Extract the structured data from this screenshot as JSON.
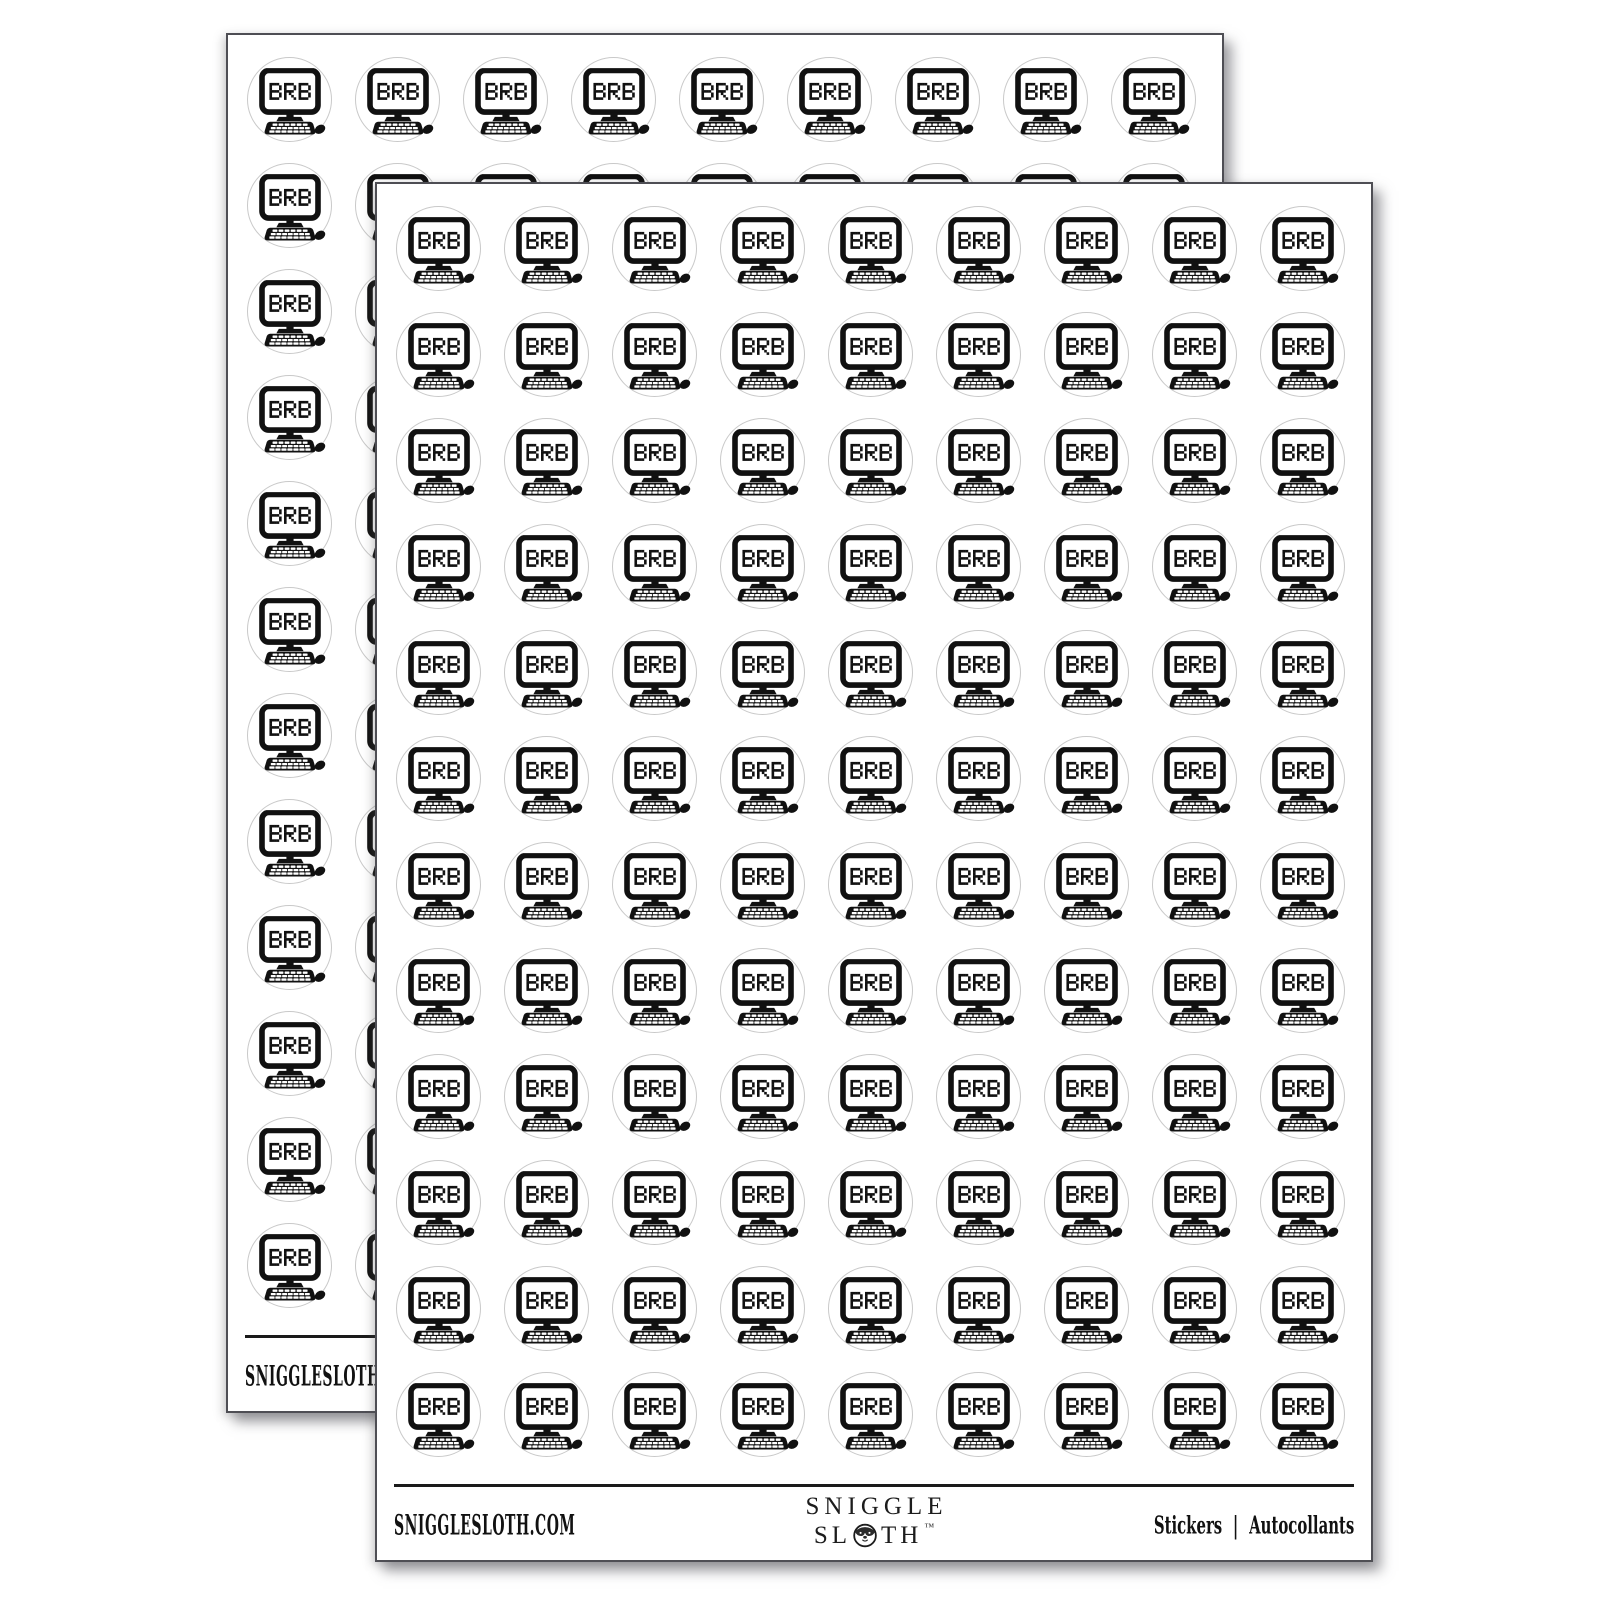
{
  "image": {
    "description": "Two overlapping white sticker sheets, each with a grid of round black-and-white BRB computer stickers",
    "background": "#ffffff"
  },
  "sticker": {
    "text": "BRB",
    "icon": "brb-computer-monitor-keyboard-mouse-icon",
    "shape": "circle",
    "grid": {
      "columns": 9,
      "rows": 12
    },
    "count_per_sheet": 108
  },
  "sheets": {
    "count": 2,
    "names": [
      "back-sheet",
      "front-sheet"
    ]
  },
  "footer": {
    "website": "SNIGGLESLOTH.COM",
    "brand_line1": "SNIGGLE",
    "brand_line2_left": "SL",
    "brand_line2_right": "TH",
    "trademark": "™",
    "brand_o_icon": "sloth-face",
    "type_english": "Stickers",
    "separator": "|",
    "type_french": "Autocollants"
  },
  "colors": {
    "ink": "#111111",
    "sticker_ring": "#c9c9c9",
    "sheet_border": "#4e4e54",
    "rule": "#1a1a1a",
    "sheet_background": "#ffffff",
    "page_background": "#ffffff"
  }
}
